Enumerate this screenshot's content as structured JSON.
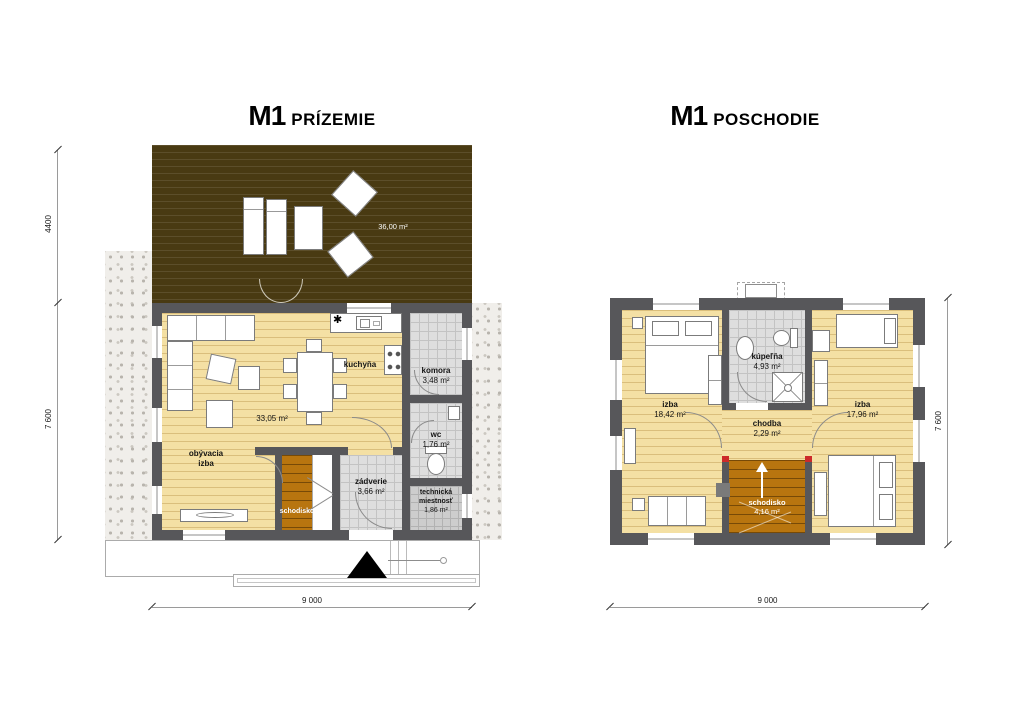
{
  "prizemie": {
    "title": {
      "model": "M1",
      "floor": "PRÍZEMIE"
    },
    "terrace": {
      "area": "36,00 m²"
    },
    "rooms": {
      "obyvacia": {
        "name1": "obývacia",
        "name2": "izba",
        "area": "33,05 m²"
      },
      "kuchyna": {
        "name1": "kuchyňa",
        "marker": "✱"
      },
      "komora": {
        "name1": "komora",
        "area": "3,48 m²"
      },
      "wc": {
        "name1": "wc",
        "area": "1,76 m²"
      },
      "zadverie": {
        "name1": "zádverie",
        "area": "3,66 m²"
      },
      "technicka": {
        "name1": "technická",
        "name2": "miestnosť",
        "area": "1,86 m²"
      },
      "schodisko": {
        "name1": "schodisko"
      }
    },
    "dimensions": {
      "terrace_depth": "4400",
      "house_depth": "7 600",
      "total_width": "9 000"
    }
  },
  "poschodie": {
    "title": {
      "model": "M1",
      "floor": "POSCHODIE"
    },
    "rooms": {
      "izba_vlavo": {
        "name1": "izba",
        "area": "18,42 m²"
      },
      "kupelna": {
        "name1": "kúpeľňa",
        "area": "4,93 m²"
      },
      "izba_vpravo": {
        "name1": "izba",
        "area": "17,96 m²"
      },
      "chodba": {
        "name1": "chodba",
        "area": "2,29 m²"
      },
      "schodisko": {
        "name1": "schodisko",
        "area": "4,16 m²"
      }
    },
    "dimensions": {
      "house_depth": "7 600",
      "total_width": "9 000"
    }
  },
  "colors": {
    "wall": "#57575a",
    "wood_floor": "#f4e0a4",
    "terrace_deck": "#493a12",
    "stair_wood": "#b8750f",
    "tile": "#dedede",
    "stair_marker_red": "#cc2a2a"
  }
}
